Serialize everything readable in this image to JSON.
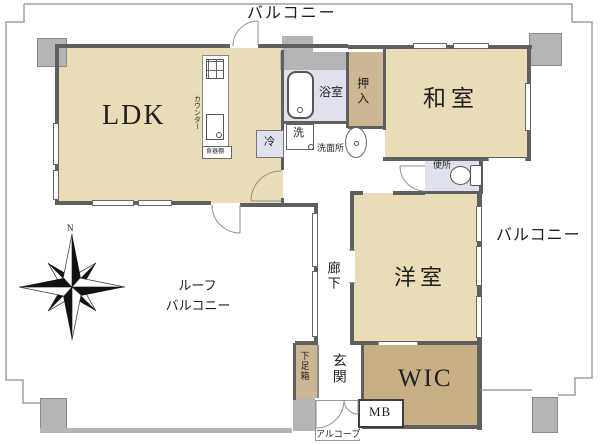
{
  "labels": {
    "balcony_top": "バルコニー",
    "balcony_right": "バルコニー",
    "roof_balcony_1": "ルーフ",
    "roof_balcony_2": "バルコニー",
    "ldk": "LDK",
    "washitsu": "和室",
    "yoshitsu": "洋室",
    "wic": "WIC",
    "oshiire": "押入",
    "bathroom": "浴室",
    "washroom": "洗面所",
    "toilet": "便所",
    "corridor": "廊下",
    "genkan": "玄関",
    "shoe_box": "下足箱",
    "alcove": "アルコーブ",
    "meter_box": "MB",
    "fridge": "冷",
    "washer": "洗",
    "counter": "カウンター",
    "cabinet": "食器棚",
    "compass_north": "N"
  },
  "colors": {
    "room_beige": "#e9dcb7",
    "closet_tan": "#cdb693",
    "wic_tan": "#c8ae84",
    "wet_blue": "#dfe2ec",
    "wall_gray": "#5f5f5f",
    "pillar_gray": "#b5b5b5"
  }
}
